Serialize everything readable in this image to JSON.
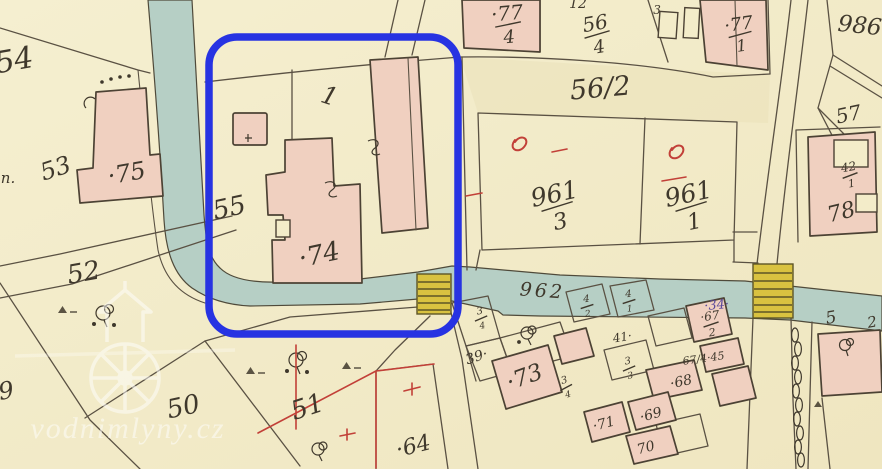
{
  "map": {
    "watermark": {
      "text": "vodnimlyny.cz"
    },
    "colors": {
      "paper": "#f3ecc9",
      "paper_shade": "#e9dfb6",
      "water": "#b6cfc5",
      "water_edge": "#4f4a3a",
      "building": "#f0d0c0",
      "building_edge": "#4c4234",
      "line": "#5a5143",
      "ink": "#3f382c",
      "red": "#c24038",
      "purple": "#5b4a9b",
      "bridge": "#d9c240",
      "bridge_edge": "#5e5526",
      "annotation": "#2733e2",
      "watermark": "#ffffff"
    },
    "labels": [
      {
        "t": "54",
        "x": 16,
        "y": 70,
        "s": 30,
        "r": -10
      },
      {
        "t": "n.",
        "x": 8,
        "y": 183,
        "s": 15,
        "r": 0
      },
      {
        "t": "53",
        "x": 58,
        "y": 176,
        "s": 24,
        "r": -18
      },
      {
        "t": "·75",
        "x": 128,
        "y": 181,
        "s": 24,
        "r": -10
      },
      {
        "t": "55",
        "x": 231,
        "y": 216,
        "s": 26,
        "r": -12
      },
      {
        "t": "52",
        "x": 85,
        "y": 281,
        "s": 26,
        "r": -10
      },
      {
        "t": "1",
        "x": 327,
        "y": 104,
        "s": 25,
        "r": 18
      },
      {
        "t": "·74",
        "x": 321,
        "y": 263,
        "s": 26,
        "r": -12
      },
      {
        "t": "56/2",
        "x": 601,
        "y": 97,
        "s": 27,
        "r": -5
      },
      {
        "t": "986",
        "x": 859,
        "y": 33,
        "s": 23,
        "r": 6
      },
      {
        "t": "57",
        "x": 850,
        "y": 121,
        "s": 20,
        "r": -12
      },
      {
        "t": "78",
        "x": 843,
        "y": 219,
        "s": 22,
        "r": -14
      },
      {
        "t": "962",
        "x": 542,
        "y": 297,
        "s": 19,
        "r": 4,
        "sp": 3
      },
      {
        "t": "50",
        "x": 185,
        "y": 415,
        "s": 26,
        "r": -12
      },
      {
        "t": "51",
        "x": 310,
        "y": 415,
        "s": 26,
        "r": -18
      },
      {
        "t": "49",
        "x": 0,
        "y": 400,
        "s": 24,
        "r": -10
      },
      {
        "t": "·64",
        "x": 415,
        "y": 453,
        "s": 22,
        "r": -14
      },
      {
        "t": "·73",
        "x": 527,
        "y": 384,
        "s": 23,
        "r": -20
      },
      {
        "t": "39·",
        "x": 478,
        "y": 361,
        "s": 14,
        "r": -18
      },
      {
        "t": "·71",
        "x": 605,
        "y": 428,
        "s": 14,
        "r": -15
      },
      {
        "t": "·69",
        "x": 652,
        "y": 419,
        "s": 14,
        "r": -15
      },
      {
        "t": "70",
        "x": 647,
        "y": 452,
        "s": 14,
        "r": -15
      },
      {
        "t": "·68",
        "x": 682,
        "y": 386,
        "s": 14,
        "r": -12
      },
      {
        "t": "41·",
        "x": 623,
        "y": 341,
        "s": 12,
        "r": -10
      },
      {
        "t": "67/4·45",
        "x": 704,
        "y": 362,
        "s": 11,
        "r": -8
      },
      {
        "t": "·34·",
        "x": 717,
        "y": 309,
        "s": 13,
        "r": -5,
        "c": "purple"
      },
      {
        "t": "5",
        "x": 832,
        "y": 323,
        "s": 17,
        "r": -10
      },
      {
        "t": "2",
        "x": 873,
        "y": 327,
        "s": 15,
        "r": -10
      },
      {
        "t": "12",
        "x": 578,
        "y": 8,
        "s": 14,
        "r": 0
      },
      {
        "t": "3",
        "x": 657,
        "y": 14,
        "s": 12,
        "r": 0
      }
    ],
    "fractions": [
      {
        "num": "·77",
        "den": "4",
        "x": 508,
        "y": 24,
        "s": 20,
        "r": -5
      },
      {
        "num": "56",
        "den": "4",
        "x": 597,
        "y": 34,
        "s": 20,
        "r": -10
      },
      {
        "num": "·77",
        "den": "1",
        "x": 740,
        "y": 34,
        "s": 18,
        "r": -8
      },
      {
        "num": "961",
        "den": "3",
        "x": 557,
        "y": 206,
        "s": 25,
        "r": -12
      },
      {
        "num": "961",
        "den": "1",
        "x": 691,
        "y": 206,
        "s": 25,
        "r": -12
      },
      {
        "num": "42",
        "den": "1",
        "x": 850,
        "y": 175,
        "s": 12,
        "r": -10
      },
      {
        "num": "3",
        "den": "4",
        "x": 481,
        "y": 318,
        "s": 10,
        "r": -10
      },
      {
        "num": "4",
        "den": "2",
        "x": 587,
        "y": 306,
        "s": 10,
        "r": -5
      },
      {
        "num": "4",
        "den": "1",
        "x": 629,
        "y": 301,
        "s": 10,
        "r": -5
      },
      {
        "num": "3",
        "den": "3",
        "x": 629,
        "y": 368,
        "s": 10,
        "r": -10
      },
      {
        "num": "·67",
        "den": "2",
        "x": 711,
        "y": 324,
        "s": 12,
        "r": -8
      },
      {
        "num": "3",
        "den": "4",
        "x": 566,
        "y": 387,
        "s": 10,
        "r": -15
      }
    ]
  }
}
